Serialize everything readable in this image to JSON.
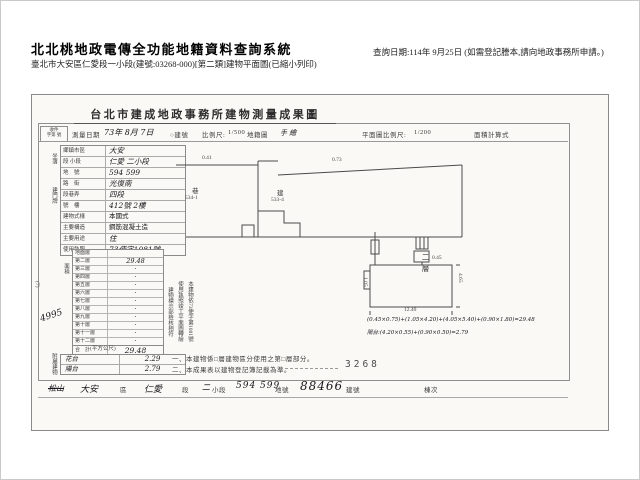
{
  "page": {
    "system_title": "北北桃地政電傳全功能地籍資料查詢系統",
    "query_date": "查詢日期:114年 9月25日 (如需登記謄本,請向地政事務所申請。)",
    "subtitle": "臺北市大安區仁愛段一小段(建號:03268-000)[第二類]建物平面圖(已縮小列印)"
  },
  "doc": {
    "title": "台北市建成地政事務所建物測量成果圖",
    "receipt": {
      "l1": "收件",
      "l2": "字第 號"
    },
    "survey": {
      "label": "測量日期",
      "value": "73年 8月 7日",
      "building_no": "○建號"
    },
    "scales": {
      "map_label": "比例尺:",
      "map_value": "1/500",
      "map_suffix": "地籍圖",
      "map_hand": "手 繪",
      "plan_label": "平面圖比例尺:",
      "plan_value": "1/200",
      "calc_label": "面積計算式"
    },
    "side": {
      "location": "坐落",
      "door": "建門牌",
      "floors": "面積",
      "annex": "附屬建物"
    },
    "form": {
      "rows": [
        {
          "l": "鄉鎮市區",
          "v": "大安"
        },
        {
          "l": "段 小段",
          "v": "仁愛 二小段"
        },
        {
          "l": "地　號",
          "v": "594 599"
        },
        {
          "l": "路　街",
          "v": "光復南"
        },
        {
          "l": "段巷弄",
          "v": "四段"
        },
        {
          "l": "號　樓",
          "v": "412號 2樓"
        },
        {
          "l": "建物式樣",
          "v": "本國式"
        },
        {
          "l": "主要構造",
          "v": "鋼筋混凝土造"
        },
        {
          "l": "主要用途",
          "v": "住"
        },
        {
          "l": "使用執照",
          "v": "73使字1081號"
        }
      ]
    },
    "floors": {
      "rows": [
        {
          "l": "地面層",
          "v": ""
        },
        {
          "l": "第二層",
          "v": "29.48"
        },
        {
          "l": "第三層",
          "v": "·"
        },
        {
          "l": "第四層",
          "v": "·"
        },
        {
          "l": "第五層",
          "v": "·"
        },
        {
          "l": "第六層",
          "v": "·"
        },
        {
          "l": "第七層",
          "v": "·"
        },
        {
          "l": "第八層",
          "v": "·"
        },
        {
          "l": "第九層",
          "v": "·"
        },
        {
          "l": "第十層",
          "v": "·"
        },
        {
          "l": "第十一層",
          "v": "·"
        },
        {
          "l": "第十二層",
          "v": "·"
        }
      ],
      "total_label": "合　計",
      "total_value": "29.48",
      "unit": "(平方公尺)"
    },
    "annex": {
      "rows": [
        {
          "u": "花台",
          "a": "2.29"
        },
        {
          "u": "陽台",
          "a": "2.79"
        }
      ]
    },
    "plans": {
      "upper": {
        "dim_left": "0.41",
        "dim_right": "0.73",
        "left_char": "巷",
        "left_no": "534-1",
        "right_char": "建",
        "right_no": "533-4"
      },
      "lower": {
        "floor_label": "二層",
        "dim_bottom": "12.40",
        "dim_right": "4.65",
        "dim_left": "1.05",
        "dim_top": "0.45",
        "calc1": "(0.45×0.75)+(1.05×4.20)+(4.05×5.40)+(0.90×1.80)=29.48",
        "calc2": "陽台:(4.20×0.55)+(0.90×0.50)=2.79"
      }
    },
    "cert": {
      "c1": "本建物依73使字第1081號",
      "c2": "使用執照竣工平面圖轉繪",
      "c3": "建物標示部檢核相符"
    },
    "notes": {
      "n1": "一、本建物係□層建物區分使用之第□層部分。",
      "n2": "二、本成果表以建物登記簿記載為準。"
    },
    "stamp": "3268",
    "stray": "4995",
    "margin_no": "(7)",
    "footer": {
      "struck": "松山",
      "district": "大安",
      "district_l": "區",
      "section": "仁愛",
      "section_l": "段",
      "sub": "二",
      "sub_l": "小段",
      "lots": "594 599",
      "lots_l": "地號",
      "bno": "88466",
      "bno_l": "建號",
      "dong_l": "棟次"
    }
  }
}
